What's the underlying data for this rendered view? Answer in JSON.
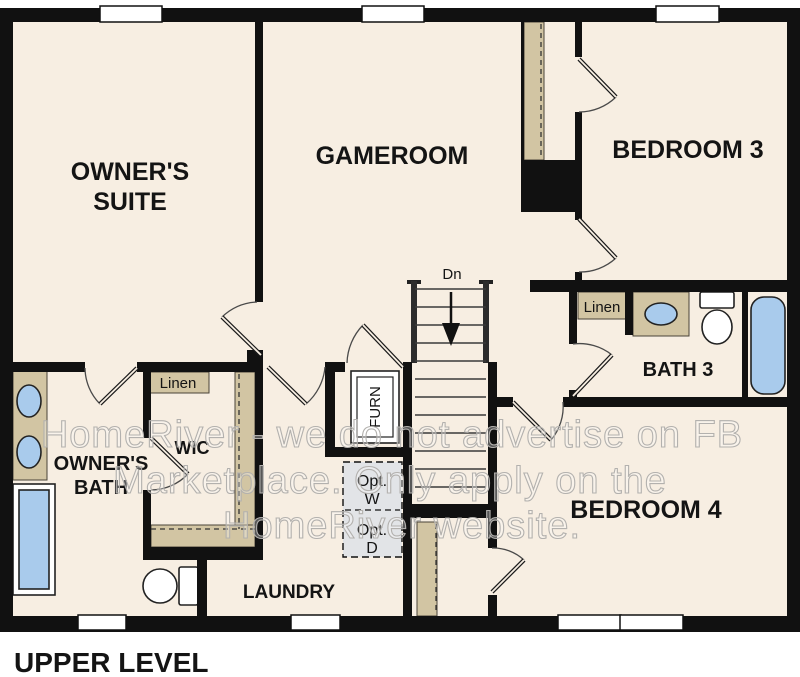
{
  "title": "UPPER LEVEL",
  "rooms": {
    "owners_suite": {
      "line1": "OWNER'S",
      "line2": "SUITE"
    },
    "gameroom": "GAMEROOM",
    "bedroom3": "BEDROOM 3",
    "bedroom4": "BEDROOM 4",
    "bath3": "BATH 3",
    "owners_bath": {
      "line1": "OWNER'S",
      "line2": "BATH"
    },
    "wic": "WIC",
    "laundry": "LAUNDRY",
    "linen_wic": "Linen",
    "linen_bath3": "Linen"
  },
  "annotations": {
    "stairs_down": "Dn",
    "furnace": "FURN",
    "opt_washer": {
      "line1": "Opt.",
      "line2": "W"
    },
    "opt_dryer": {
      "line1": "Opt.",
      "line2": "D"
    }
  },
  "watermark": {
    "line1": "HomeRiver - we do not advertise on FB",
    "line2": "Marketplace. Only apply on the",
    "line3": "HomeRiver website."
  },
  "colors": {
    "floor": "#f7eee2",
    "wall": "#111111",
    "counter_tan": "#d2c5a3",
    "fixture_blue": "#a9cbec",
    "optional_appliance_fill": "#e2e4e7",
    "watermark_gray": "#b3b1ae"
  }
}
